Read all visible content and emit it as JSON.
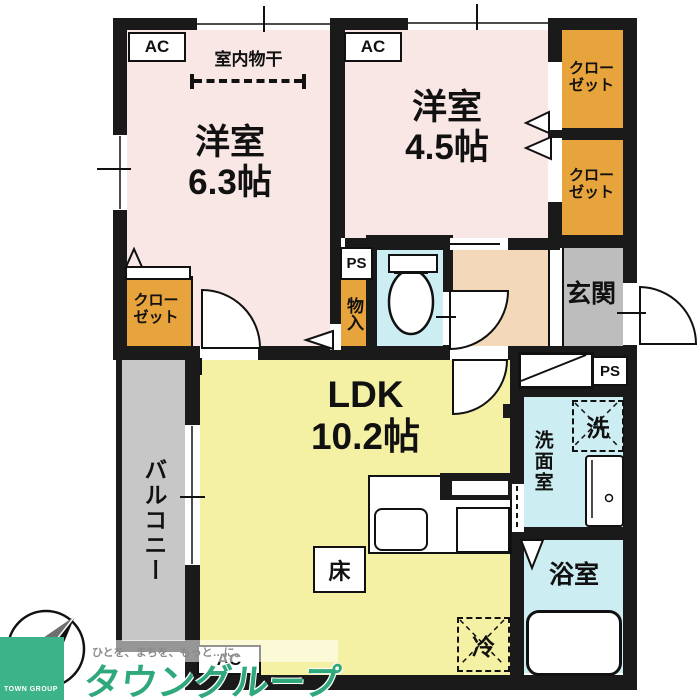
{
  "plan": {
    "rooms": {
      "bedroom_63": {
        "name": "洋室",
        "size": "6.3帖"
      },
      "bedroom_45": {
        "name": "洋室",
        "size": "4.5帖"
      },
      "ldk": {
        "name": "LDK",
        "size": "10.2帖"
      },
      "entrance": "玄関",
      "balcony": "バルコニー",
      "washroom": "洗面室",
      "bathroom": "浴室",
      "storage": "物入"
    },
    "labels": {
      "closet_line1": "クロー",
      "closet_line2": "ゼット",
      "indoor_drying": "室内物干",
      "floor": "床",
      "washer": "洗",
      "fridge": "冷",
      "ac": "AC",
      "ps": "PS"
    },
    "colors": {
      "wall": "#1a1a1a",
      "bedroom": "#f8e7e5",
      "ldk": "#f5f1a4",
      "wet_area": "#cceef2",
      "hall": "#f3d8b9",
      "entrance": "#bdbdbd",
      "balcony": "#c7c7c7",
      "closet": "#e7a33c",
      "brand_green": "#2fa87c"
    }
  },
  "logo": {
    "company": "TOWN GROUP",
    "brand": "タウングループ",
    "slogan": "ひとを、まちを、もっと…に。"
  }
}
